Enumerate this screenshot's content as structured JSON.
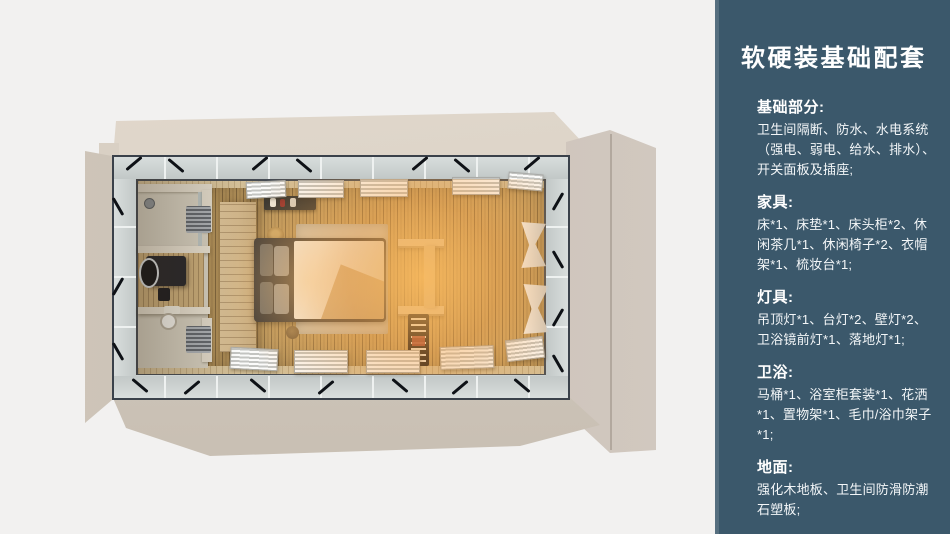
{
  "panel": {
    "title": "软硬装基础配套",
    "sections": [
      {
        "heading": "基础部分:",
        "body": "卫生间隔断、防水、水电系统（强电、弱电、给水、排水）、开关面板及插座;"
      },
      {
        "heading": "家具:",
        "body": "床*1、床垫*1、床头柜*2、休闲茶几*1、休闲椅子*2、衣帽架*1、梳妆台*1;"
      },
      {
        "heading": "灯具:",
        "body": "吊顶灯*1、台灯*2、壁灯*2、卫浴镜前灯*1、落地灯*1;"
      },
      {
        "heading": "卫浴:",
        "body": "马桶*1、浴室柜套装*1、花洒*1、置物架*1、毛巾/浴巾架子*1;"
      },
      {
        "heading": "地面:",
        "body": "强化木地板、卫生间防滑防潮石塑板;"
      }
    ],
    "colors": {
      "background": "#3b586b",
      "edge_highlight": "#52707e",
      "text": "#ffffff"
    }
  },
  "floorplan": {
    "view": "top-down 3D render of a container-home bedroom with bathroom",
    "colors": {
      "shell": "#d5ccc0",
      "glass_band": "#cbd1d0",
      "window_frame": "#3a414a",
      "wood_floor": "#c6a164",
      "warm_glow": "#f5a64d",
      "bathroom_wall": "#ded7c8",
      "wardrobe_wood": "#d2b88e",
      "bed_frame": "#3f3b38",
      "duvet": "#f0ede7",
      "rug": "#cdc4b3",
      "curtain": "#efede9"
    }
  }
}
